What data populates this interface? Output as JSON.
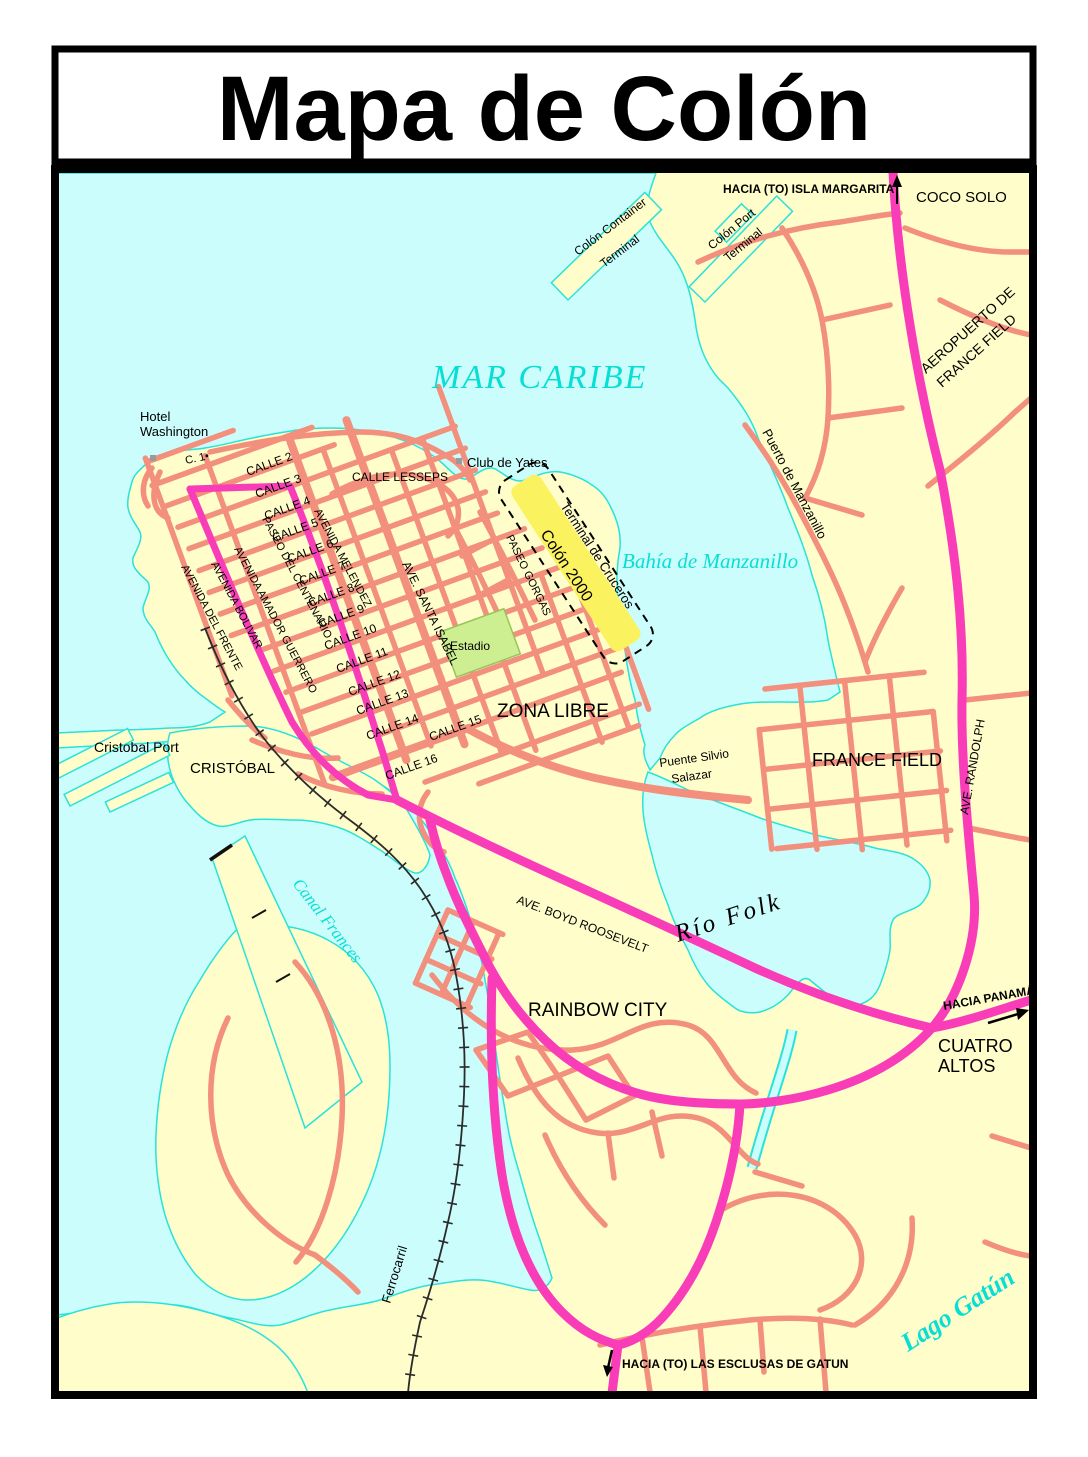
{
  "title": "Mapa de Colón",
  "colors": {
    "water": "#CBFDFC",
    "coast_line": "#29E2DB",
    "land": "#FFFDC9",
    "road_salmon": "#F28F7D",
    "highway_magenta": "#F93DB9",
    "terminal_yellow": "#FBF25F",
    "stadium_green": "#CDEF92",
    "water_text_cyan": "#07DFD4"
  },
  "map": {
    "water_labels": {
      "mar_caribe": "MAR CARIBE",
      "bahia": "Bahía de Manzanillo",
      "rio_folk": "Río Folk",
      "canal_frances": "Canal Frances",
      "lago_gatun": "Lago Gatún"
    },
    "places": {
      "hacia_isla_margarita": "HACIA (TO) ISLA MARGARITA",
      "coco_solo": "COCO SOLO",
      "colon_container_1": "Colón Container",
      "colon_container_2": "Terminal",
      "colon_port_1": "Colón Port",
      "colon_port_2": "Terminal",
      "aeropuerto_1": "AEROPUERTO DE",
      "aeropuerto_2": "FRANCE FIELD",
      "puerto_manzanillo": "Puerto de Manzanillo",
      "hotel_washington_1": "Hotel",
      "hotel_washington_2": "Washington",
      "club_de_yates": "Club de Yates",
      "terminal_cruceros": "Terminal de Cruceros",
      "colon_2000": "Colón 2000",
      "estadio": "Estadio",
      "zona_libre": "ZONA LIBRE",
      "cristobal_port": "Cristobal Port",
      "cristobal": "CRISTÓBAL",
      "puente_1": "Puente Silvio",
      "puente_2": "Salazar",
      "france_field": "FRANCE FIELD",
      "rainbow_city": "RAINBOW CITY",
      "hacia_panama": "HACIA PANAMÁ",
      "cuatro_altos_1": "CUATRO",
      "cuatro_altos_2": "ALTOS",
      "ferrocarril": "Ferrocarril",
      "hacia_esclusas": "HACIA (TO) LAS ESCLUSAS DE GATUN"
    },
    "streets": {
      "c1": "C. 1•",
      "calles": [
        "CALLE 2",
        "CALLE 3",
        "CALLE 4",
        "CALLE 5",
        "CALLE 6",
        "CALLE 7",
        "CALLE 8",
        "CALLE 9",
        "CALLE 10",
        "CALLE 11",
        "CALLE 12",
        "CALLE 13",
        "CALLE 14",
        "CALLE 15",
        "CALLE 16"
      ],
      "avenidas": [
        "AVENIDA DEL FRENTE",
        "AVENIDA BOLIVAR",
        "AVENIDA AMADOR GUERRERO",
        "PASEO DEL CENTENARIO",
        "AVENIDA MELENDEZ"
      ],
      "lesseps": "CALLE LESSEPS",
      "santa_isabel": "AVE. SANTA ISABEL",
      "gorgas": "PASEO GORGAS",
      "randolph": "AVE. RANDOLPH",
      "boyd_roosevelt": "AVE. BOYD ROOSEVELT"
    }
  }
}
